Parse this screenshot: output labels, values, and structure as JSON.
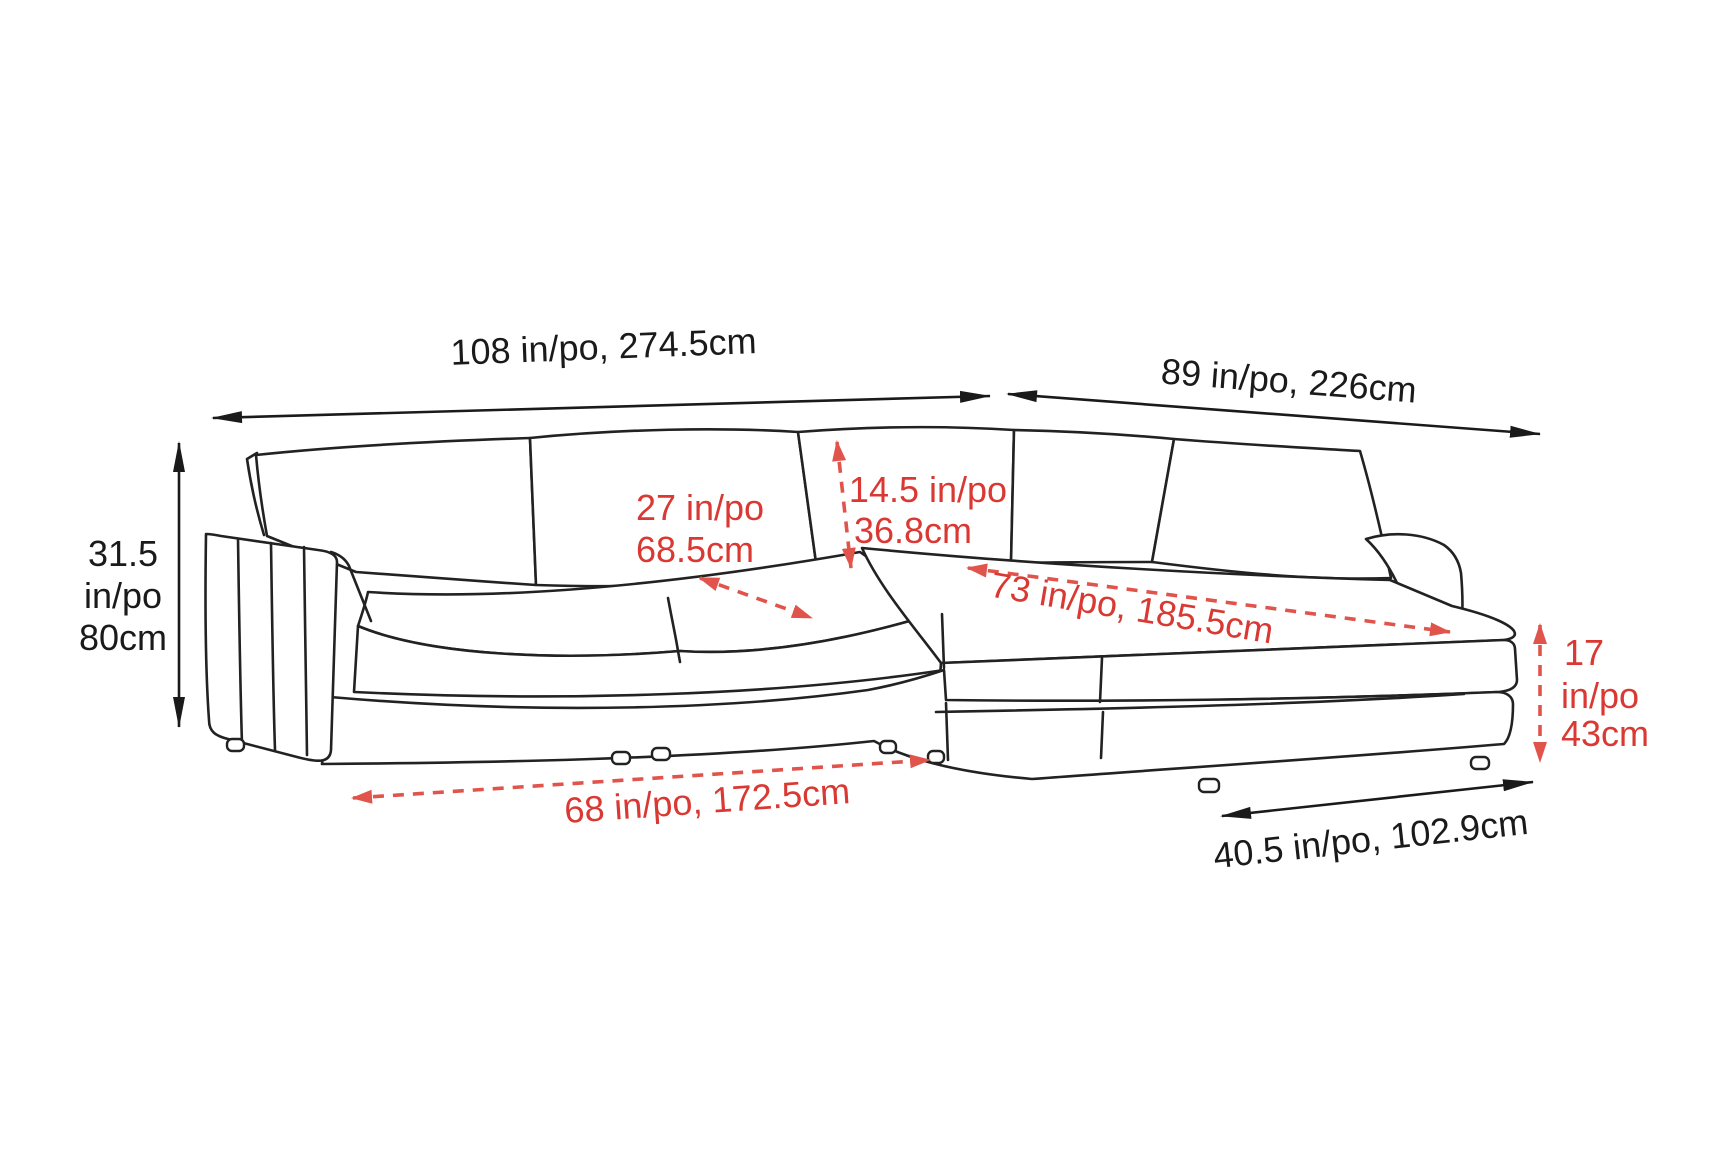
{
  "diagram": {
    "type": "sofa-sectional-dimension-diagram",
    "colors": {
      "line": "#222222",
      "label_text": "#1a1a1a",
      "red_text": "#da3832",
      "red_arrow": "#e0544c",
      "background": "#ffffff"
    },
    "dimensions": {
      "sofa_width": {
        "label": "108 in/po, 274.5cm"
      },
      "chaise_side_width": {
        "label": "89 in/po, 226cm"
      },
      "overall_height": {
        "line1": "31.5",
        "line2": "in/po",
        "line3": "80cm"
      },
      "seat_depth": {
        "line1": "27 in/po",
        "line2": "68.5cm"
      },
      "back_cushion_height": {
        "line1": "14.5 in/po",
        "line2": "36.8cm"
      },
      "chaise_length": {
        "label": "73 in/po, 185.5cm"
      },
      "base_width": {
        "label": "68 in/po, 172.5cm"
      },
      "seat_height": {
        "line1": "17",
        "line2": "in/po",
        "line3": "43cm"
      },
      "chaise_width": {
        "label": "40.5 in/po, 102.9cm"
      }
    }
  }
}
